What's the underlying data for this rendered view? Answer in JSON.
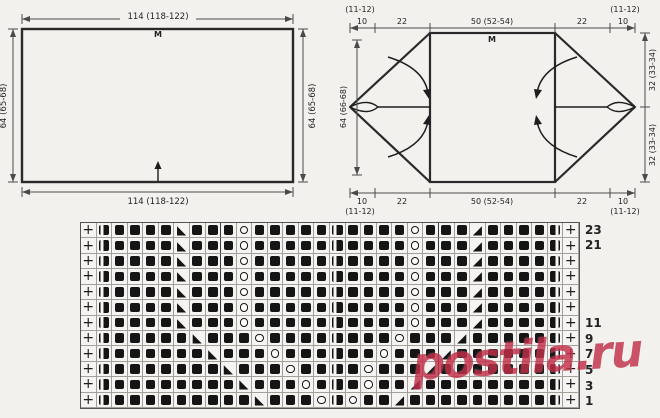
{
  "flat_schematic": {
    "width_top": "114 (118-122)",
    "width_bottom": "114 (118-122)",
    "height_left": "64 (65-68)",
    "height_right": "64 (65-68)",
    "center_marker": "M"
  },
  "folded_schematic": {
    "top_dims": [
      "10",
      "22",
      "50 (52-54)",
      "22",
      "10"
    ],
    "bottom_dims": [
      "10",
      "22",
      "50 (52-54)",
      "22",
      "10"
    ],
    "size_note": "(11-12)",
    "height_left": "64 (66-68)",
    "height_right_top": "32 (33-34)",
    "height_right_bottom": "32 (33-34)",
    "center_marker": "M"
  },
  "knitting_chart": {
    "columns": 32,
    "repeat_boundaries_after_columns": [
      9,
      23
    ],
    "symbols": {
      "+": "plus-edge-stitch",
      "F": "filled-square",
      "L": "half-filled-square-stripe-left",
      "R": "half-filled-square-stripe-right",
      "O": "open-circle",
      "<": "lower-left-black-triangle",
      ">": "lower-right-black-triangle"
    },
    "rows": [
      {
        "num": "23",
        "cells": "+LFFFF<FFFOFFFFFLFFFFOFFF>FFFFR+"
      },
      {
        "num": "21",
        "cells": "+LFFFF<FFFOFFFFFLFFFFOFFF>FFFFR+"
      },
      {
        "num": "",
        "cells": "+LFFFF<FFFOFFFFFLFFFFOFFF>FFFFR+"
      },
      {
        "num": "",
        "cells": "+LFFFF<FFFOFFFFFLFFFFOFFF>FFFFR+"
      },
      {
        "num": "",
        "cells": "+LFFFF<FFFOFFFFFLFFFFOFFF>FFFFR+"
      },
      {
        "num": "",
        "cells": "+LFFFF<FFFOFFFFFLFFFFOFFF>FFFFR+"
      },
      {
        "num": "11",
        "cells": "+LFFFF<FFFOFFFFFLFFFFOFFF>FFFFR+"
      },
      {
        "num": "9",
        "cells": "+LFFFFF<FFFOFFFFLFFFOFFF>FFFFFR+"
      },
      {
        "num": "7",
        "cells": "+LFFFFFF<FFFOFFFLFFOFFF>FFFFFFR+"
      },
      {
        "num": "5",
        "cells": "+LFFFFFFF<FFFOFFLFOFFF>FFFFFFFR+"
      },
      {
        "num": "3",
        "cells": "+LFFFFFFFF<FFFOFLFOFF>FFFFFFFFR+"
      },
      {
        "num": "1",
        "cells": "+LFFFFFFFFF<FFFOLOFF>FFFFFFFFFR+"
      }
    ]
  },
  "watermark": {
    "text": "postila.ru",
    "color": "#c23049"
  }
}
